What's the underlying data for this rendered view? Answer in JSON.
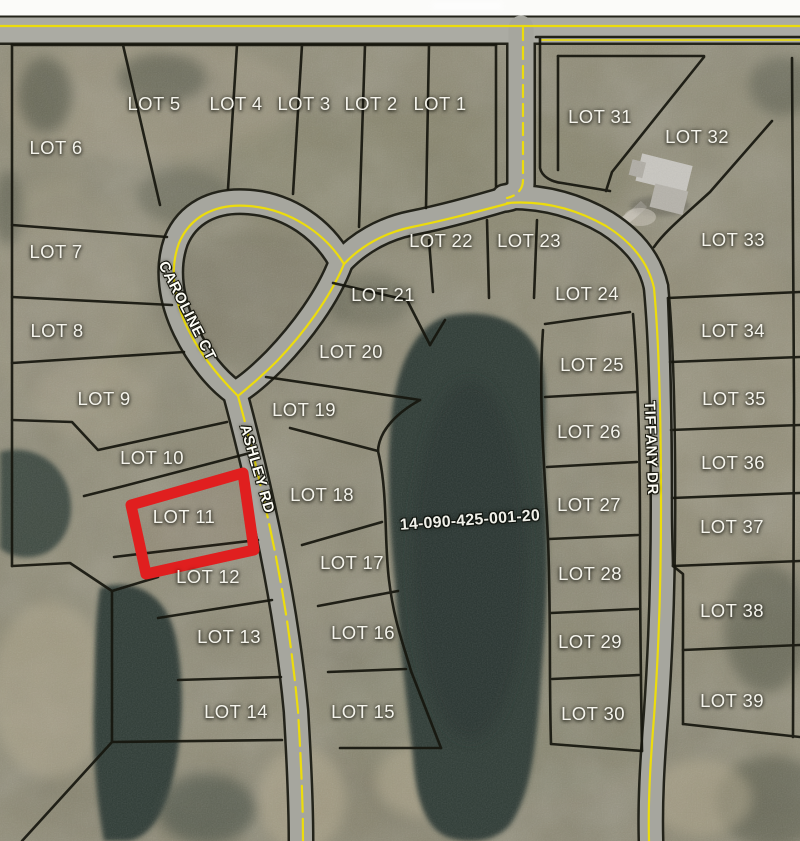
{
  "map": {
    "description": "Aerial subdivision plat map with numbered lots",
    "parcel": {
      "label": "14-090-425-001-20",
      "x": 470,
      "y": 521,
      "rotation": -4
    },
    "highlighted_lot": "LOT 11",
    "colors": {
      "highlight": "#e01f1f",
      "road_edge_line": "#ecdc0c",
      "lot_line": "#16160e",
      "water": "#2e3a35",
      "terrain": "#8d8973"
    },
    "labels": {
      "lots": [
        {
          "label": "LOT 1",
          "x": 440,
          "y": 104
        },
        {
          "label": "LOT 2",
          "x": 371,
          "y": 104
        },
        {
          "label": "LOT 3",
          "x": 304,
          "y": 104
        },
        {
          "label": "LOT 4",
          "x": 236,
          "y": 104
        },
        {
          "label": "LOT 5",
          "x": 154,
          "y": 104
        },
        {
          "label": "LOT 6",
          "x": 56,
          "y": 148
        },
        {
          "label": "LOT 7",
          "x": 56,
          "y": 252
        },
        {
          "label": "LOT 8",
          "x": 57,
          "y": 331
        },
        {
          "label": "LOT 9",
          "x": 104,
          "y": 399
        },
        {
          "label": "LOT 10",
          "x": 152,
          "y": 458
        },
        {
          "label": "LOT 11",
          "x": 184,
          "y": 517
        },
        {
          "label": "LOT 12",
          "x": 208,
          "y": 577
        },
        {
          "label": "LOT 13",
          "x": 229,
          "y": 637
        },
        {
          "label": "LOT 14",
          "x": 236,
          "y": 712
        },
        {
          "label": "LOT 15",
          "x": 363,
          "y": 712
        },
        {
          "label": "LOT 16",
          "x": 363,
          "y": 633
        },
        {
          "label": "LOT 17",
          "x": 352,
          "y": 563
        },
        {
          "label": "LOT 18",
          "x": 322,
          "y": 495
        },
        {
          "label": "LOT 19",
          "x": 304,
          "y": 410
        },
        {
          "label": "LOT 20",
          "x": 351,
          "y": 352
        },
        {
          "label": "LOT 21",
          "x": 383,
          "y": 295
        },
        {
          "label": "LOT 22",
          "x": 441,
          "y": 241
        },
        {
          "label": "LOT 23",
          "x": 529,
          "y": 241
        },
        {
          "label": "LOT 24",
          "x": 587,
          "y": 294
        },
        {
          "label": "LOT 25",
          "x": 592,
          "y": 365
        },
        {
          "label": "LOT 26",
          "x": 589,
          "y": 432
        },
        {
          "label": "LOT 27",
          "x": 589,
          "y": 505
        },
        {
          "label": "LOT 28",
          "x": 590,
          "y": 574
        },
        {
          "label": "LOT 29",
          "x": 590,
          "y": 642
        },
        {
          "label": "LOT 30",
          "x": 593,
          "y": 714
        },
        {
          "label": "LOT 31",
          "x": 600,
          "y": 117
        },
        {
          "label": "LOT 32",
          "x": 697,
          "y": 137
        },
        {
          "label": "LOT 33",
          "x": 733,
          "y": 240
        },
        {
          "label": "LOT 34",
          "x": 733,
          "y": 331
        },
        {
          "label": "LOT 35",
          "x": 734,
          "y": 399
        },
        {
          "label": "LOT 36",
          "x": 733,
          "y": 463
        },
        {
          "label": "LOT 37",
          "x": 732,
          "y": 527
        },
        {
          "label": "LOT 38",
          "x": 732,
          "y": 611
        },
        {
          "label": "LOT 39",
          "x": 732,
          "y": 701
        }
      ],
      "roads": [
        {
          "label": "CAROLINE CT",
          "x": 187,
          "y": 311,
          "rotation": 63
        },
        {
          "label": "ASHLEY RD",
          "x": 257,
          "y": 469,
          "rotation": 74
        },
        {
          "label": "TIFFANY DR",
          "x": 651,
          "y": 448,
          "rotation": 88
        }
      ]
    }
  }
}
